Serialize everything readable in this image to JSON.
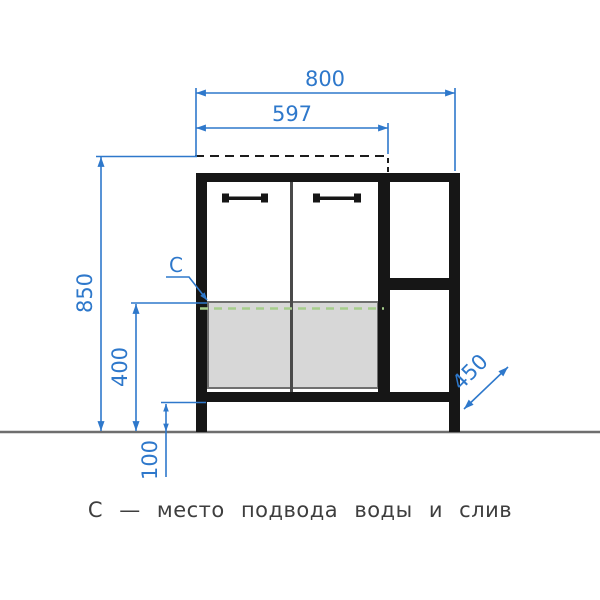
{
  "drawing": {
    "title": "vanity cabinet front elevation",
    "caption": "С — место подвода воды и слив",
    "dimensions": {
      "overall_width_mm": "800",
      "sink_top_width_mm": "597",
      "overall_height_mm": "850",
      "service_area_height_mm": "400",
      "plinth_height_mm": "100",
      "depth_mm": "450"
    },
    "labels": {
      "service_point": "C"
    },
    "colors": {
      "dimension_blue": "#2e78cb",
      "outline_black": "#161616",
      "door_divider_gray": "#4a4a4a",
      "service_area_fill": "#d7d7d7",
      "service_area_border": "#6f6f6f",
      "water_line_green": "#a6cd8c",
      "floor_line_gray": "#6e6e6e",
      "countertop_dash_black": "#1c1c1c",
      "caption_gray": "#3e3e3e"
    }
  }
}
